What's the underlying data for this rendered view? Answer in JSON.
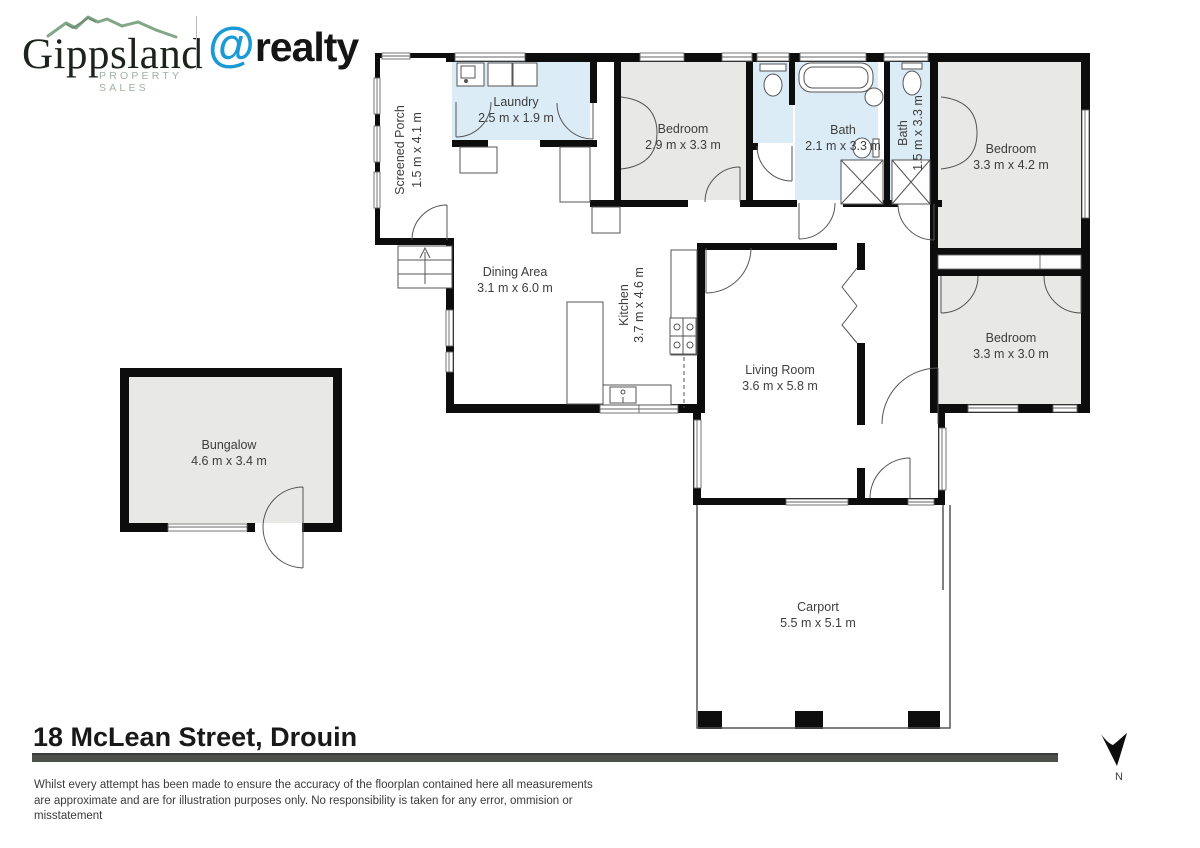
{
  "header": {
    "brand_primary": {
      "name": "Gippsland",
      "tagline": "PROPERTY SALES"
    },
    "brand_secondary": {
      "at": "@",
      "name": "realty"
    }
  },
  "floorplan": {
    "rooms": [
      {
        "id": "screened-porch",
        "name": "Screened Porch",
        "dims": "1.5 m x 4.1 m"
      },
      {
        "id": "laundry",
        "name": "Laundry",
        "dims": "2.5 m x 1.9 m"
      },
      {
        "id": "bedroom-1",
        "name": "Bedroom",
        "dims": "2.9 m x 3.3 m"
      },
      {
        "id": "bath-main",
        "name": "Bath",
        "dims": "2.1 m x 3.3 m"
      },
      {
        "id": "bath-second",
        "name": "Bath",
        "dims": "1.5 m x 3.3 m"
      },
      {
        "id": "bedroom-2",
        "name": "Bedroom",
        "dims": "3.3 m x 4.2 m"
      },
      {
        "id": "dining-area",
        "name": "Dining Area",
        "dims": "3.1 m x 6.0 m"
      },
      {
        "id": "kitchen",
        "name": "Kitchen",
        "dims": "3.7 m x 4.6 m"
      },
      {
        "id": "living-room",
        "name": "Living Room",
        "dims": "3.6 m x 5.8 m"
      },
      {
        "id": "bedroom-3",
        "name": "Bedroom",
        "dims": "3.3 m x 3.0 m"
      },
      {
        "id": "bungalow",
        "name": "Bungalow",
        "dims": "4.6 m x 3.4 m"
      },
      {
        "id": "carport",
        "name": "Carport",
        "dims": "5.5 m x 5.1 m"
      }
    ],
    "compass": {
      "label": "N"
    }
  },
  "footer": {
    "address": "18 McLean Street, Drouin",
    "disclaimer_lines": [
      "Whilst every attempt has been made to ensure the accuracy of the floorplan contained here all measurements",
      "are approximate and are for illustration purposes only. No responsibility is taken for any error, ommision or",
      "misstatement"
    ]
  },
  "colors": {
    "wet_area_fill": "#dcecf7",
    "room_fill": "#e8e8e7",
    "wall": "#0d0d0d",
    "brand_green": "#84a688",
    "brand_blue": "#1b9ad6",
    "rule_gray": "#4b504b"
  }
}
